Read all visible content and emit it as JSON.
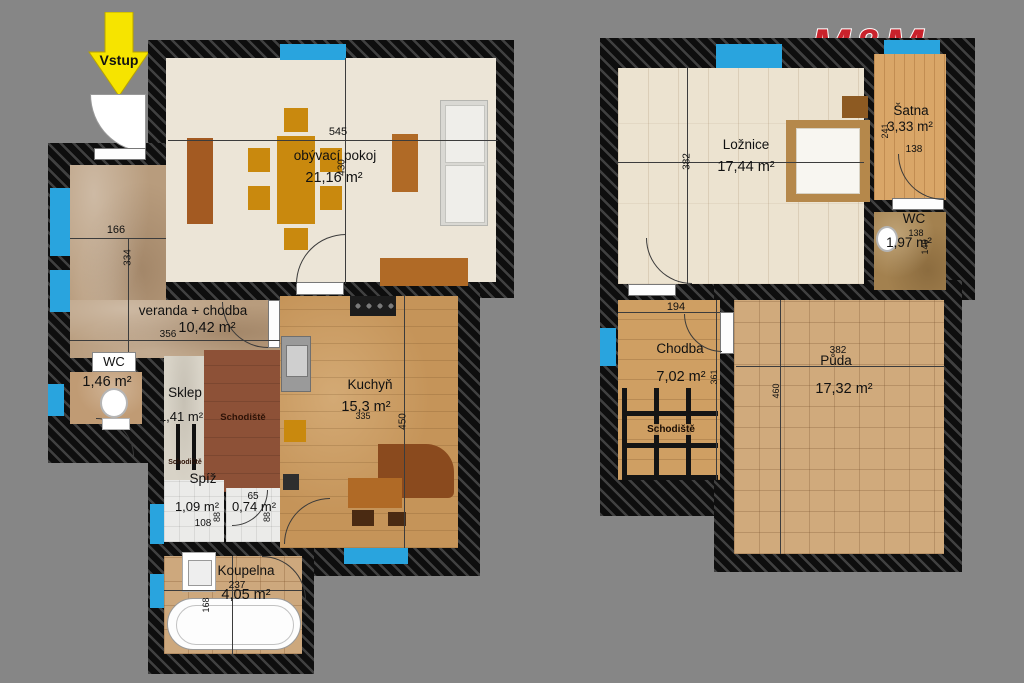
{
  "background": "#868686",
  "entrance": {
    "label": "Vstup"
  },
  "logo": {
    "top": "M&M",
    "bottom": "REALITY",
    "red": "#c9222b",
    "blue": "#1d86c8"
  },
  "colors": {
    "wall": "#0e0e0e",
    "window_blue": "#29a4de",
    "arrow_yellow": "#f6e400"
  },
  "floor1": {
    "obyvaci": {
      "label": "obývací pokoj",
      "area": "21,16 m²",
      "dim_w": "545",
      "dim_h": "430"
    },
    "veranda": {
      "label": "veranda + chodba",
      "area": "10,42 m²",
      "dim_top": "166",
      "dim_side": "334",
      "dim_bottom": "356"
    },
    "wc": {
      "label": "WC",
      "area": "1,46 m²"
    },
    "sklep": {
      "label": "Sklep",
      "area": "1,41 m²",
      "note": "Schodiště"
    },
    "schodiste": {
      "label": "Schodiště"
    },
    "kuchyn": {
      "label": "Kuchyň",
      "area": "15,3 m²",
      "dim_w": "335",
      "dim_h": "450"
    },
    "spiz": {
      "label": "Spíž",
      "area": "1,09 m²",
      "dim_w": "108",
      "dim_h": "88"
    },
    "komora": {
      "area": "0,74 m²",
      "dim_w": "65",
      "dim_h": "88"
    },
    "koupelna": {
      "label": "Koupelna",
      "area": "4,05 m²",
      "dim_w": "237",
      "dim_h": "168"
    }
  },
  "floor2": {
    "loznice": {
      "label": "Ložnice",
      "area": "17,44 m²",
      "dim_h": "382"
    },
    "satna": {
      "label": "Šatna",
      "area": "3,33 m²",
      "dim_w": "138",
      "dim_h": "241"
    },
    "wc": {
      "label": "WC",
      "area": "1,97 m²",
      "dim_w": "138",
      "dim_h": "146"
    },
    "chodba": {
      "label": "Chodba",
      "area": "7,02 m²",
      "dim_w": "194",
      "dim_h": "361"
    },
    "schodiste": {
      "label": "Schodiště"
    },
    "puda": {
      "label": "Půda",
      "area": "17,32 m²",
      "dim_w": "382",
      "dim_h": "460"
    }
  }
}
